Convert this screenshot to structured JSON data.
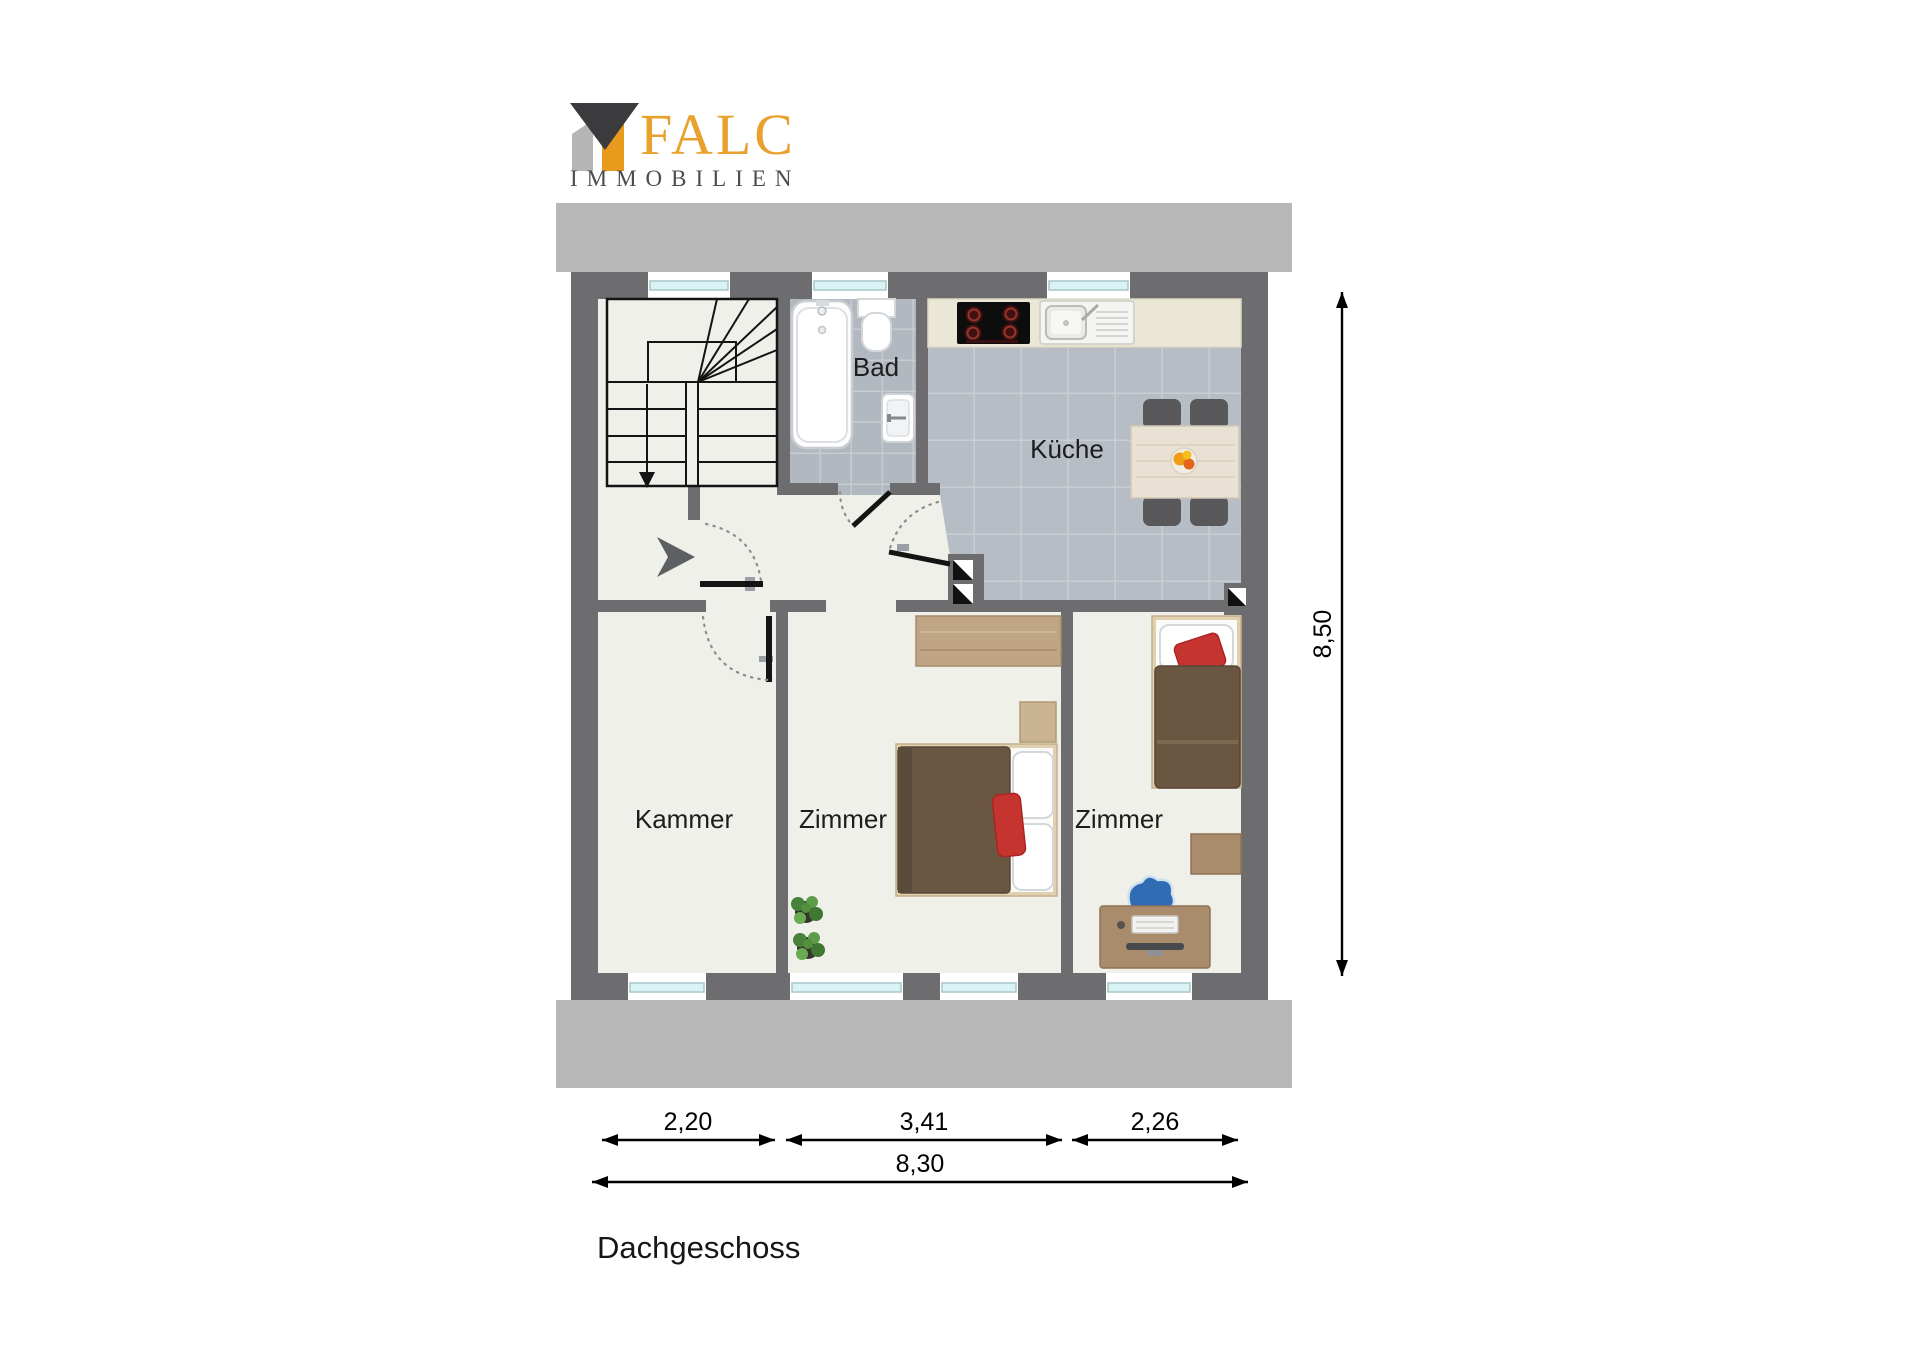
{
  "logo": {
    "brand": "FALC",
    "subtitle": "IMMOBILIEN"
  },
  "floor": {
    "title": "Dachgeschoss"
  },
  "rooms": {
    "bad": "Bad",
    "kueche": "Küche",
    "kammer": "Kammer",
    "zimmer_mitte": "Zimmer",
    "zimmer_rechts": "Zimmer"
  },
  "dimensions": {
    "segments": [
      {
        "label": "2,20"
      },
      {
        "label": "3,41"
      },
      {
        "label": "2,26"
      }
    ],
    "total_width": "8,30",
    "height": "8,50"
  },
  "colors": {
    "brand_orange": "#e9a12e",
    "logo_dark": "#3b3b3d",
    "logo_gray": "#b5b5b5",
    "wall_gray": "#6d6d6f",
    "roof_band": "#b8b8b8",
    "floor_light": "#eef0e9",
    "bath_tile": "#b1b8bf",
    "kitchen_tile": "#b6bdc5",
    "window_glass": "#d9f3f5",
    "counter_cream": "#eae7d7",
    "blanket_brown": "#6b5741",
    "pillow_red": "#c63430",
    "chair_blue": "#2f6cb3",
    "wood": "#a98c6c"
  }
}
